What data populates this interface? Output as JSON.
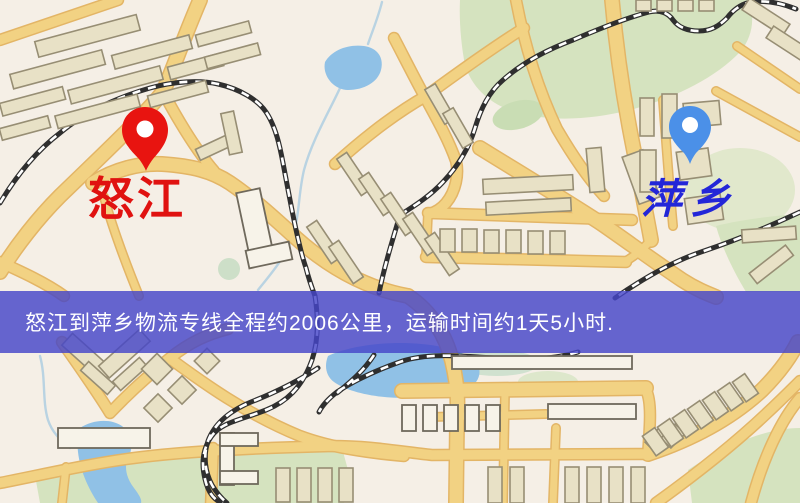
{
  "banner": {
    "text": "怒江到萍乡物流专线全程约2006公里，运输时间约1天5小时.",
    "distance_km": "2006",
    "duration": "1天5小时",
    "bg_color": "rgba(70,70,200,0.82)",
    "text_color": "#ffffff"
  },
  "markers": {
    "origin": {
      "label": "怒江",
      "pin_color": "#e81410",
      "label_color": "#e01210"
    },
    "destination": {
      "label": "萍乡",
      "pin_color": "#4b90e8",
      "label_color": "#2326d8"
    }
  },
  "map_palette": {
    "background": "#f5efe6",
    "road": "#f2d283",
    "road_casing": "#e3b566",
    "water": "#90c1e6",
    "park": "#d5e3bf",
    "building": "#e8e1c6",
    "building_light": "#f7f3e9",
    "railway": "#2f2f2f"
  }
}
